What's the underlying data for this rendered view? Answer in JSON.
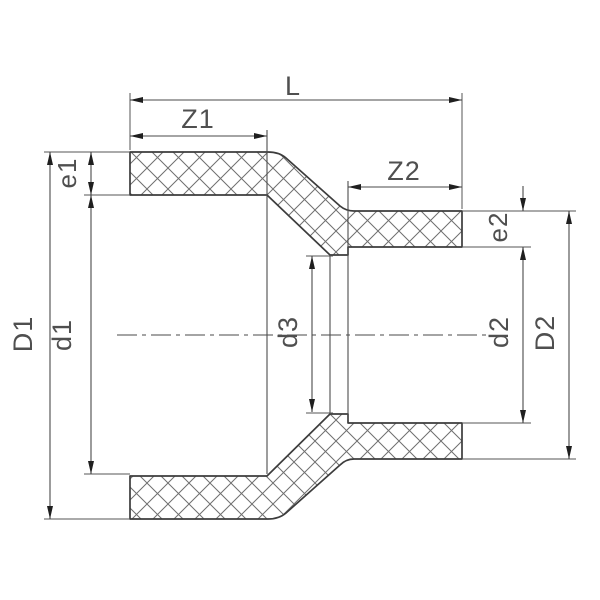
{
  "diagram": {
    "kind": "technical-drawing-reducing-coupling-cross-section",
    "labels": {
      "L": "L",
      "Z1": "Z1",
      "Z2": "Z2",
      "e1": "e1",
      "e2": "e2",
      "D1": "D1",
      "d1": "d1",
      "d3": "d3",
      "d2": "d2",
      "D2": "D2"
    },
    "colors": {
      "background": "#ffffff",
      "outline": "#3c3c3c",
      "dimension_lines": "#4a4a4a",
      "hatch": "#6f6f6f",
      "arrows": "#1f1f1f",
      "text": "#4f4f4f"
    }
  }
}
